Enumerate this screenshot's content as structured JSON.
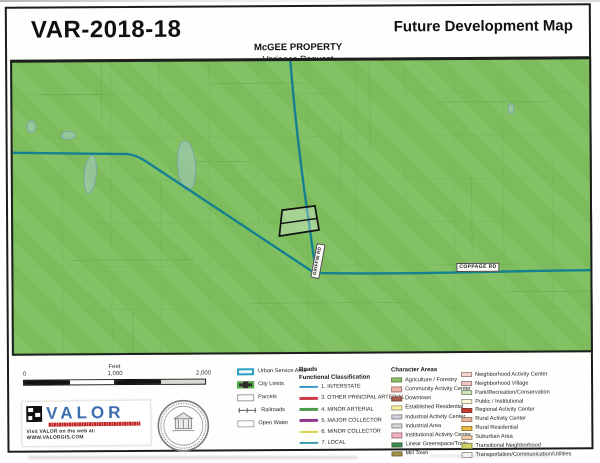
{
  "colors": {
    "land": "#7ec05f",
    "road": "#15808f"
  },
  "header": {
    "case_number": "VAR-2018-18",
    "map_title": "Future Development Map",
    "property_name": "McGEE PROPERTY",
    "request_type": "Variance Request"
  },
  "map": {
    "labels": {
      "coppage": "COPPAGE RD",
      "griffin": "GRIFFIN RD"
    }
  },
  "scalebar": {
    "unit_label": "Feet",
    "tick_start": "0",
    "tick_mid": "1,000",
    "tick_end": "2,000"
  },
  "branding": {
    "logo_text": "VALOR",
    "tagline": "Visit VALOR on the web at: WWW.VALORGIS.COM"
  },
  "legend_boundaries": {
    "items": [
      {
        "label": "Urban Service Area",
        "swatch": "urban-service-area-swatch"
      },
      {
        "label": "City Limits",
        "swatch": "city-limits-swatch"
      },
      {
        "label": "Parcels",
        "swatch": "parcels-swatch"
      },
      {
        "label": "Railroads",
        "swatch": "railroads-swatch"
      },
      {
        "label": "Open Water",
        "swatch": "open-water-swatch"
      }
    ]
  },
  "legend_roads": {
    "title_line1": "Roads",
    "title_line2": "Functional Classification",
    "items": [
      {
        "label": "1. INTERSTATE",
        "color": "#3b99cc"
      },
      {
        "label": "3. OTHER PRINCIPAL ARTERIAL",
        "color": "#cc3b4a"
      },
      {
        "label": "4. MINOR ARTERIAL",
        "color": "#4e9b4e"
      },
      {
        "label": "5. MAJOR COLLECTOR",
        "color": "#93368f"
      },
      {
        "label": "6. MINOR COLLECTOR",
        "color": "#d8d44d"
      },
      {
        "label": "7. LOCAL",
        "color": "#3e9fb0"
      }
    ]
  },
  "legend_character": {
    "title": "Character Areas",
    "col1": [
      {
        "label": "Agriculture / Forestry",
        "color": "#8dc163"
      },
      {
        "label": "Community Activity Center",
        "color": "#f0b3a6"
      },
      {
        "label": "Downtown",
        "color": "#b05a50"
      },
      {
        "label": "Established Residential",
        "color": "#fbf3a0"
      },
      {
        "label": "Industrial Activity Center",
        "color": "#d8d2de"
      },
      {
        "label": "Industrial Area",
        "color": "#d9d9d9"
      },
      {
        "label": "Institutional Activity Center",
        "color": "#f3afc1"
      },
      {
        "label": "Linear Greenspace/Trails",
        "color": "#3c8f4c"
      },
      {
        "label": "Mill Town",
        "color": "#a3913f"
      }
    ],
    "col2": [
      {
        "label": "Neighborhood Activity Center",
        "color": "#f7d6cf"
      },
      {
        "label": "Neighborhood Village",
        "color": "#f2c4c4"
      },
      {
        "label": "Park/Recreation/Conservation",
        "color": "#cfe3b2"
      },
      {
        "label": "Public / Institutional",
        "color": "#fcf7d7"
      },
      {
        "label": "Regional Activity Center",
        "color": "#c4392f"
      },
      {
        "label": "Rural Activity Center",
        "color": "#eeb29b"
      },
      {
        "label": "Rural Residential",
        "color": "#efbd43"
      },
      {
        "label": "Suburban Area",
        "color": "#f3cfad"
      },
      {
        "label": "Transitional Neighborhood",
        "color": "#ced162"
      },
      {
        "label": "Transportation/Communication/Utilities",
        "color": "#f4f2ee"
      }
    ]
  }
}
